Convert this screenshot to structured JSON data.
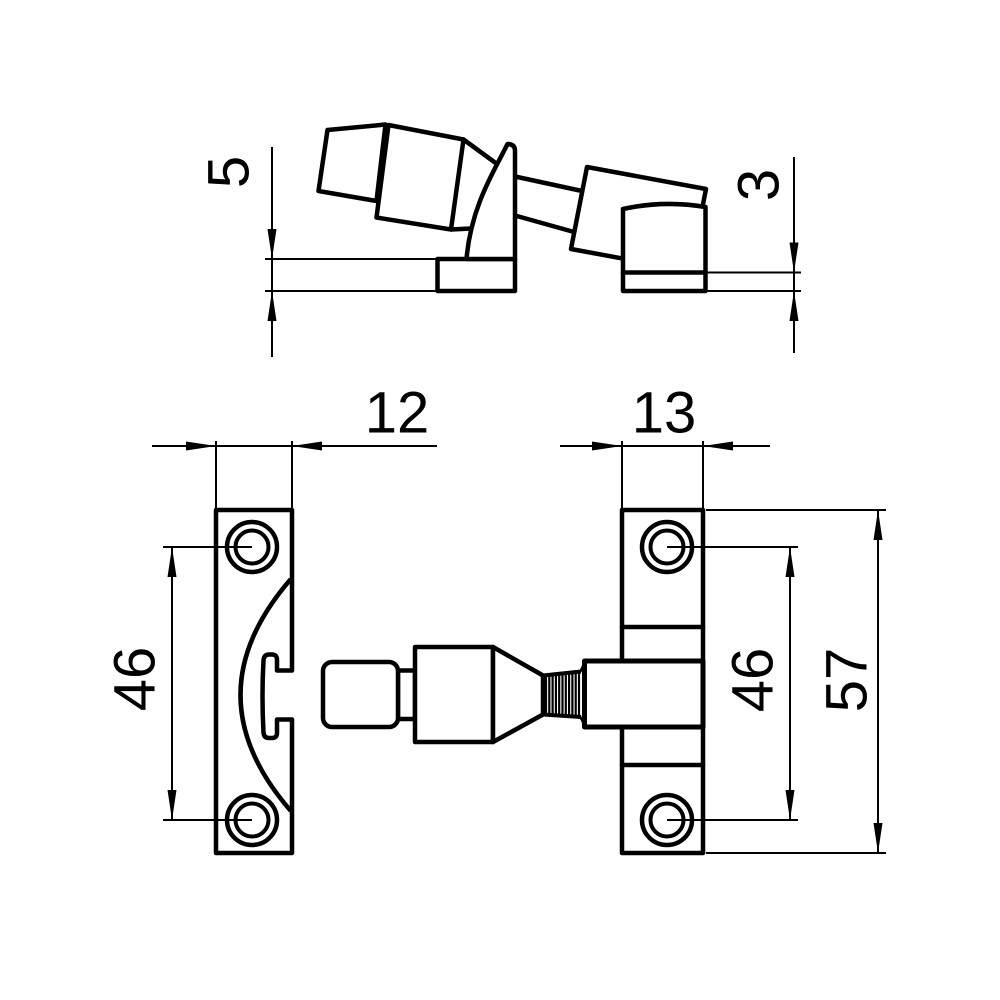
{
  "colors": {
    "background": "#ffffff",
    "line": "#000000"
  },
  "drawing": {
    "type": "technical-dimension-drawing",
    "subject": "window-sash-fastener-three-views",
    "side_view": {
      "base_plate_height": "5",
      "keep_plate_height": "3"
    },
    "latch_plate": {
      "width": "12",
      "hole_spacing": "46"
    },
    "keep_plate": {
      "width": "13",
      "hole_spacing": "46",
      "overall_height": "57"
    }
  }
}
